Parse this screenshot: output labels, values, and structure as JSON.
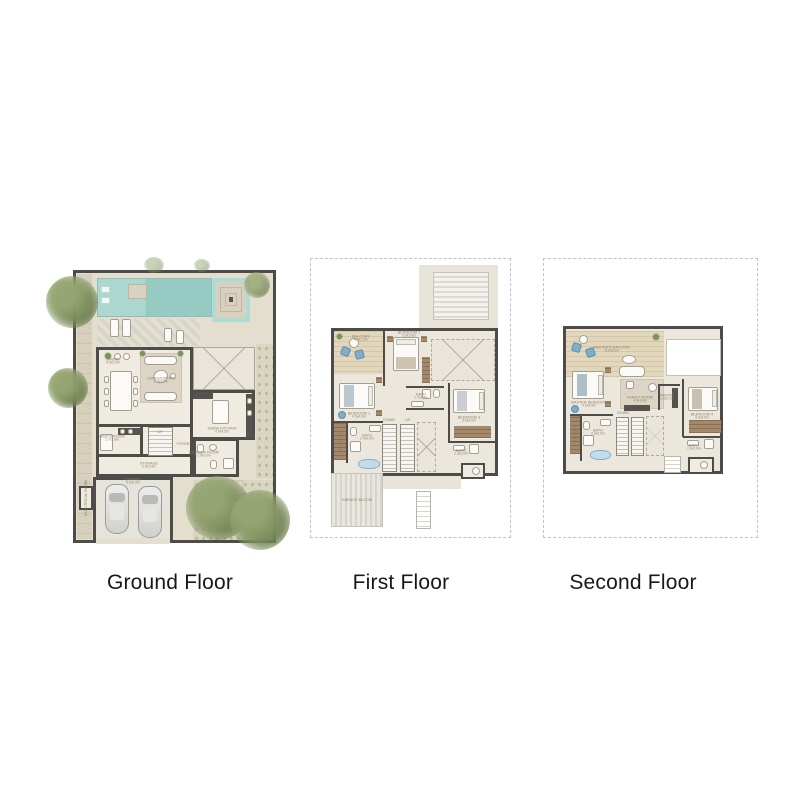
{
  "page": {
    "background": "#ffffff",
    "description": "Three-level villa floor plan sheet"
  },
  "colors": {
    "wall": "#4d4c48",
    "floor": "#ebe7dc",
    "pool": "#a9d6cf",
    "wood": "#e2d6bb",
    "greenery": "#87986a",
    "accent_blue": "#7fadcc",
    "dashed_border": "#c2c2c2",
    "label_text": "#8b7c66",
    "title_text": "#17181a"
  },
  "floors": [
    {
      "id": "ground-floor",
      "label": "Ground Floor",
      "rooms": [
        {
          "name": "DINING",
          "dims": "4.0x2.5m"
        },
        {
          "name": "LIVING/SITTING",
          "dims": "5.5x5.0m"
        },
        {
          "name": "SHOW KITCHEN",
          "dims": "4.5x4.5m"
        },
        {
          "name": "MAID'S ROOM",
          "dims": "2.7x2.6m"
        },
        {
          "name": "STORAGE",
          "dims": "2.0x1.6m"
        },
        {
          "name": "GARAGE",
          "dims": "6.0x6.0m"
        },
        {
          "name": "POWDER ROOM",
          "dims": "1.5x2.0m"
        },
        {
          "name": "FOYER"
        },
        {
          "name": "ELECTRICAL ROOM"
        },
        {
          "name": "UP"
        }
      ]
    },
    {
      "id": "first-floor",
      "label": "First Floor",
      "rooms": [
        {
          "name": "BALCONY",
          "dims": "4.5x2.0m"
        },
        {
          "name": "BEDROOM 2",
          "dims": "3.9x3.8m"
        },
        {
          "name": "BEDROOM 1",
          "dims": "4.5x4.0m"
        },
        {
          "name": "BEDROOM 3",
          "dims": "3.5x4.0m"
        },
        {
          "name": "BATH",
          "dims": "1.7x2.4m"
        },
        {
          "name": "BATH",
          "dims": "2.4x2.0m"
        },
        {
          "name": "BATH",
          "dims": "2.3x2.0m"
        },
        {
          "name": "W.I.CLOSET"
        },
        {
          "name": "GARAGE BELOW"
        },
        {
          "name": "DOWN"
        },
        {
          "name": "UP"
        }
      ]
    },
    {
      "id": "second-floor",
      "label": "Second Floor",
      "rooms": [
        {
          "name": "MASTER'S BALCONY",
          "dims": "5.0x3.0m"
        },
        {
          "name": "MASTER BEDROOM",
          "dims": "4.5x4.0m"
        },
        {
          "name": "FAMILY ROOM",
          "dims": "4.0x3.6m"
        },
        {
          "name": "PANTRY",
          "dims": "1.6x2.1m"
        },
        {
          "name": "BEDROOM 4",
          "dims": "3.3x4.0m"
        },
        {
          "name": "BATH",
          "dims": "2.3x2.0m"
        },
        {
          "name": "BATH",
          "dims": "2.4x2.0m"
        },
        {
          "name": "W.I.CLOSET"
        },
        {
          "name": "DOWN"
        }
      ]
    }
  ]
}
